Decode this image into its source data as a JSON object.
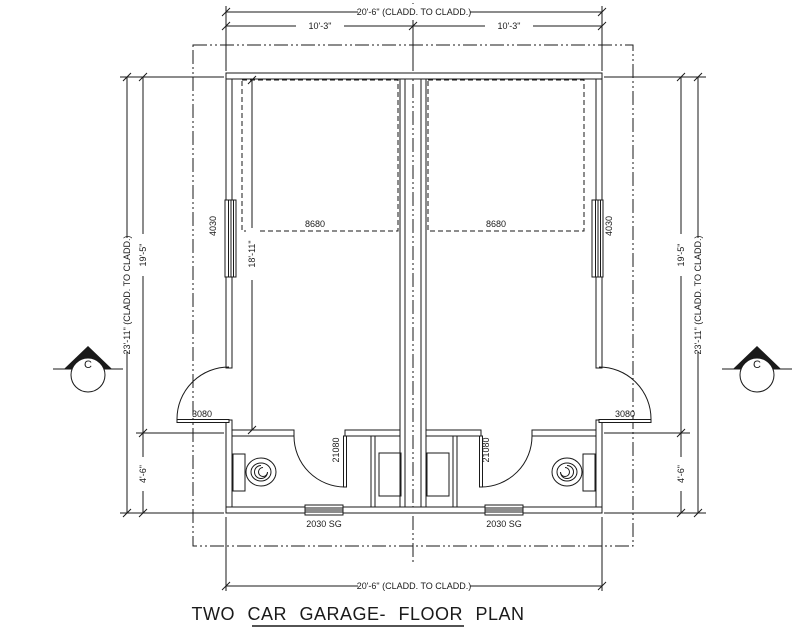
{
  "title": "TWO CAR GARAGE- FLOOR PLAN",
  "dimensions": {
    "overall_width_top": "20'-6\" (CLADD. TO CLADD.)",
    "bay_width_left": "10'-3\"",
    "bay_width_right": "10'-3\"",
    "overall_width_bottom": "20'-6\" (CLADD. TO CLADD.)",
    "overall_depth_left": "23'-11\" (CLADD. TO CLADD.)",
    "garage_depth_left": "19'-5\"",
    "store_depth_left": "4'-6\"",
    "overall_depth_right": "23'-11\" (CLADD. TO CLADD.)",
    "garage_depth_right": "19'-5\"",
    "store_depth_right": "4'-6\"",
    "interior_depth": "18'-11\""
  },
  "openings": {
    "garage_door_left": "8680",
    "garage_door_right": "8680",
    "side_window_left": "4030",
    "side_window_right": "4030",
    "side_door_left": "3080",
    "side_door_right": "3080",
    "interior_door_left": "21080",
    "interior_door_right": "21080",
    "rear_window_left": "2030 SG",
    "rear_window_right": "2030 SG"
  },
  "section_markers": {
    "left": "C",
    "right": "C"
  },
  "colors": {
    "line": "#1a1a1a",
    "background": "#ffffff"
  }
}
